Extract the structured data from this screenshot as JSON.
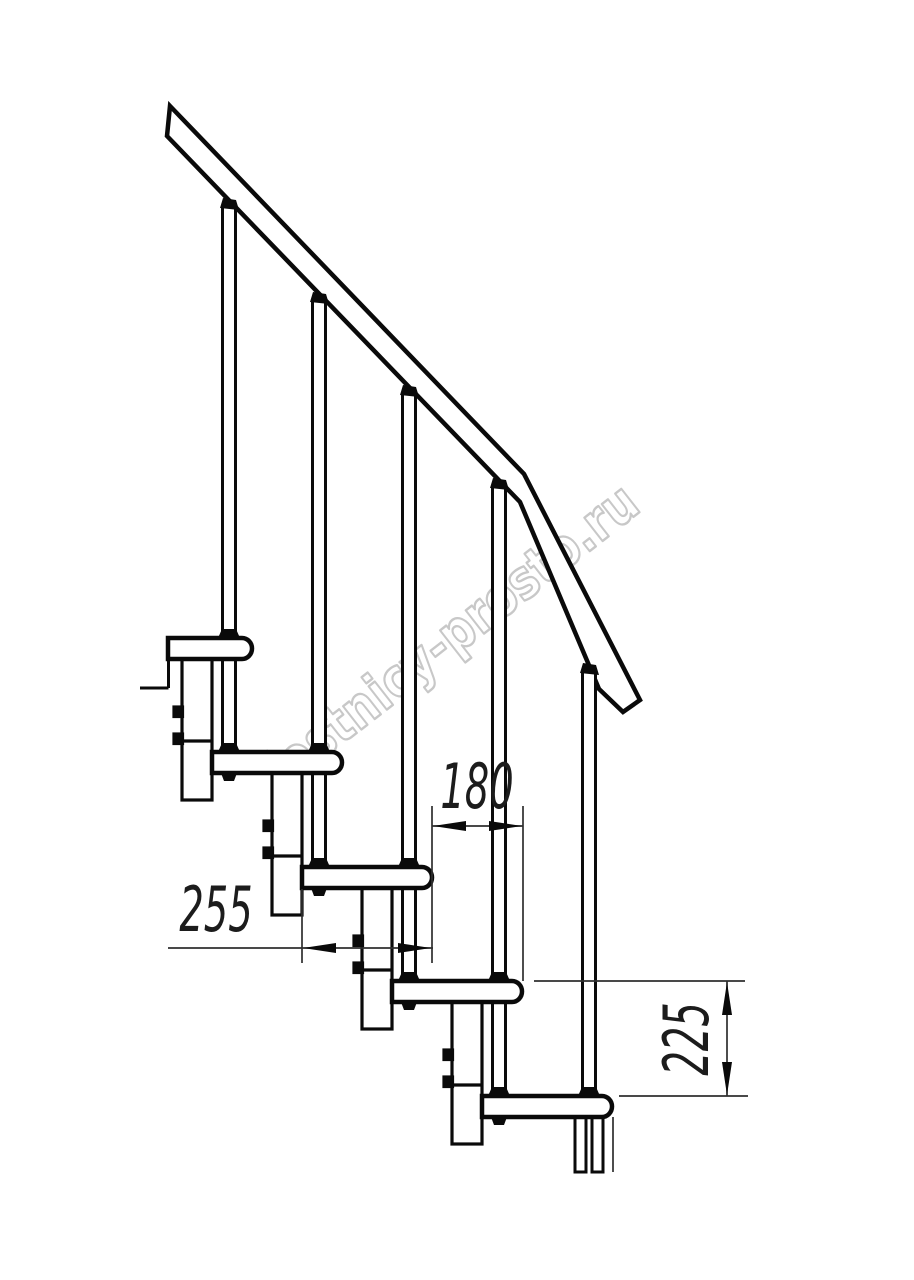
{
  "drawing": {
    "type": "staircase-side-view-technical-drawing",
    "watermark": {
      "text": "lestnicy-prosto.ru",
      "color": "#c8c8c8"
    },
    "dimensions": {
      "tread_depth": "255",
      "step_run": "180",
      "step_rise": "225"
    },
    "colors": {
      "line": "#0a0a0a",
      "thin_line": "#2f2f2f",
      "background": "#ffffff"
    }
  }
}
